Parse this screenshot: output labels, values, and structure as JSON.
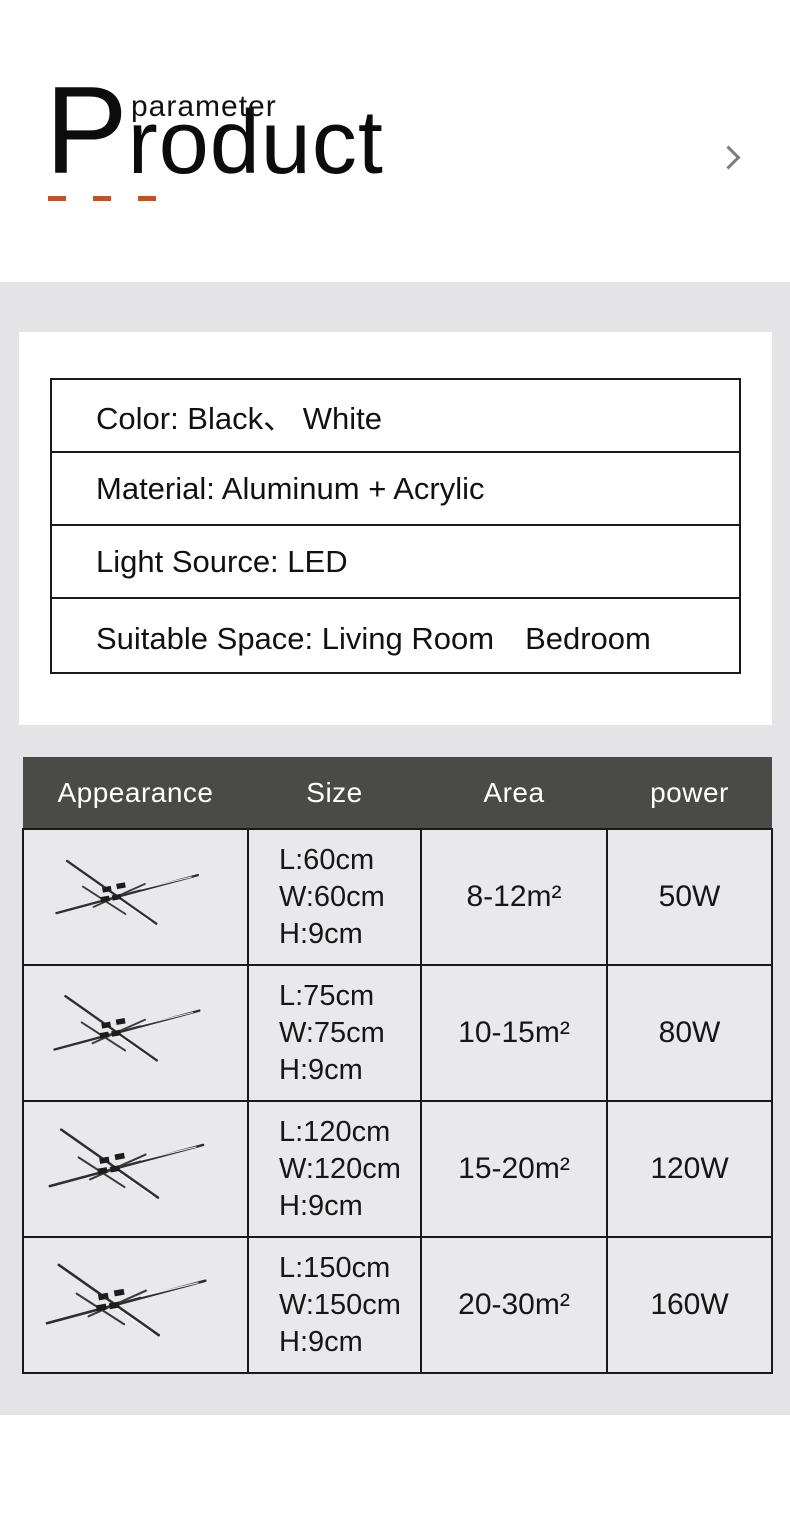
{
  "header": {
    "superscript": "parameter",
    "title_initial": "P",
    "title_rest": "roduct"
  },
  "specs": {
    "rows": [
      {
        "label": "Color: Black、 White"
      },
      {
        "label": "Material: Aluminum + Acrylic"
      },
      {
        "label": "Light Source: LED"
      },
      {
        "label": "Suitable Space: Living Room　Bedroom"
      }
    ]
  },
  "size_table": {
    "columns": [
      "Appearance",
      "Size",
      "Area",
      "power"
    ],
    "rows": [
      {
        "icon": "ceiling-lamp-icon",
        "size_lines": [
          "L:60cm",
          "W:60cm",
          "H:9cm"
        ],
        "area": "8-12m²",
        "power": "50W"
      },
      {
        "icon": "ceiling-lamp-icon",
        "size_lines": [
          "L:75cm",
          "W:75cm",
          "H:9cm"
        ],
        "area": "10-15m²",
        "power": "80W"
      },
      {
        "icon": "ceiling-lamp-icon",
        "size_lines": [
          "L:120cm",
          "W:120cm",
          "H:9cm"
        ],
        "area": "15-20m²",
        "power": "120W"
      },
      {
        "icon": "ceiling-lamp-icon",
        "size_lines": [
          "L:150cm",
          "W:150cm",
          "H:9cm"
        ],
        "area": "20-30m²",
        "power": "160W"
      }
    ]
  },
  "colors": {
    "accent_dash": "#c8501e",
    "table_header_bg": "#4a4a48",
    "band_bg": "#e4e4e6",
    "cell_bg": "#e9e9eb",
    "border": "#191919",
    "chevron": "#7d7d7d"
  }
}
